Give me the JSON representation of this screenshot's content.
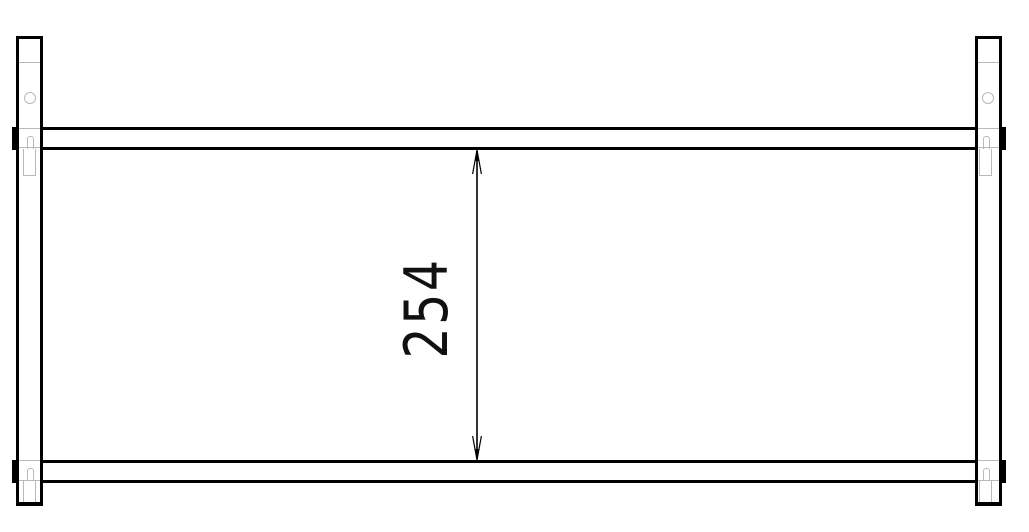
{
  "drawing": {
    "dimension": {
      "label": "254",
      "orientation": "vertical",
      "measures": "clear distance between top rail and bottom rail"
    },
    "colors": {
      "line": "#000000",
      "hidden_line": "#b9b9b9",
      "background": "#ffffff"
    }
  }
}
